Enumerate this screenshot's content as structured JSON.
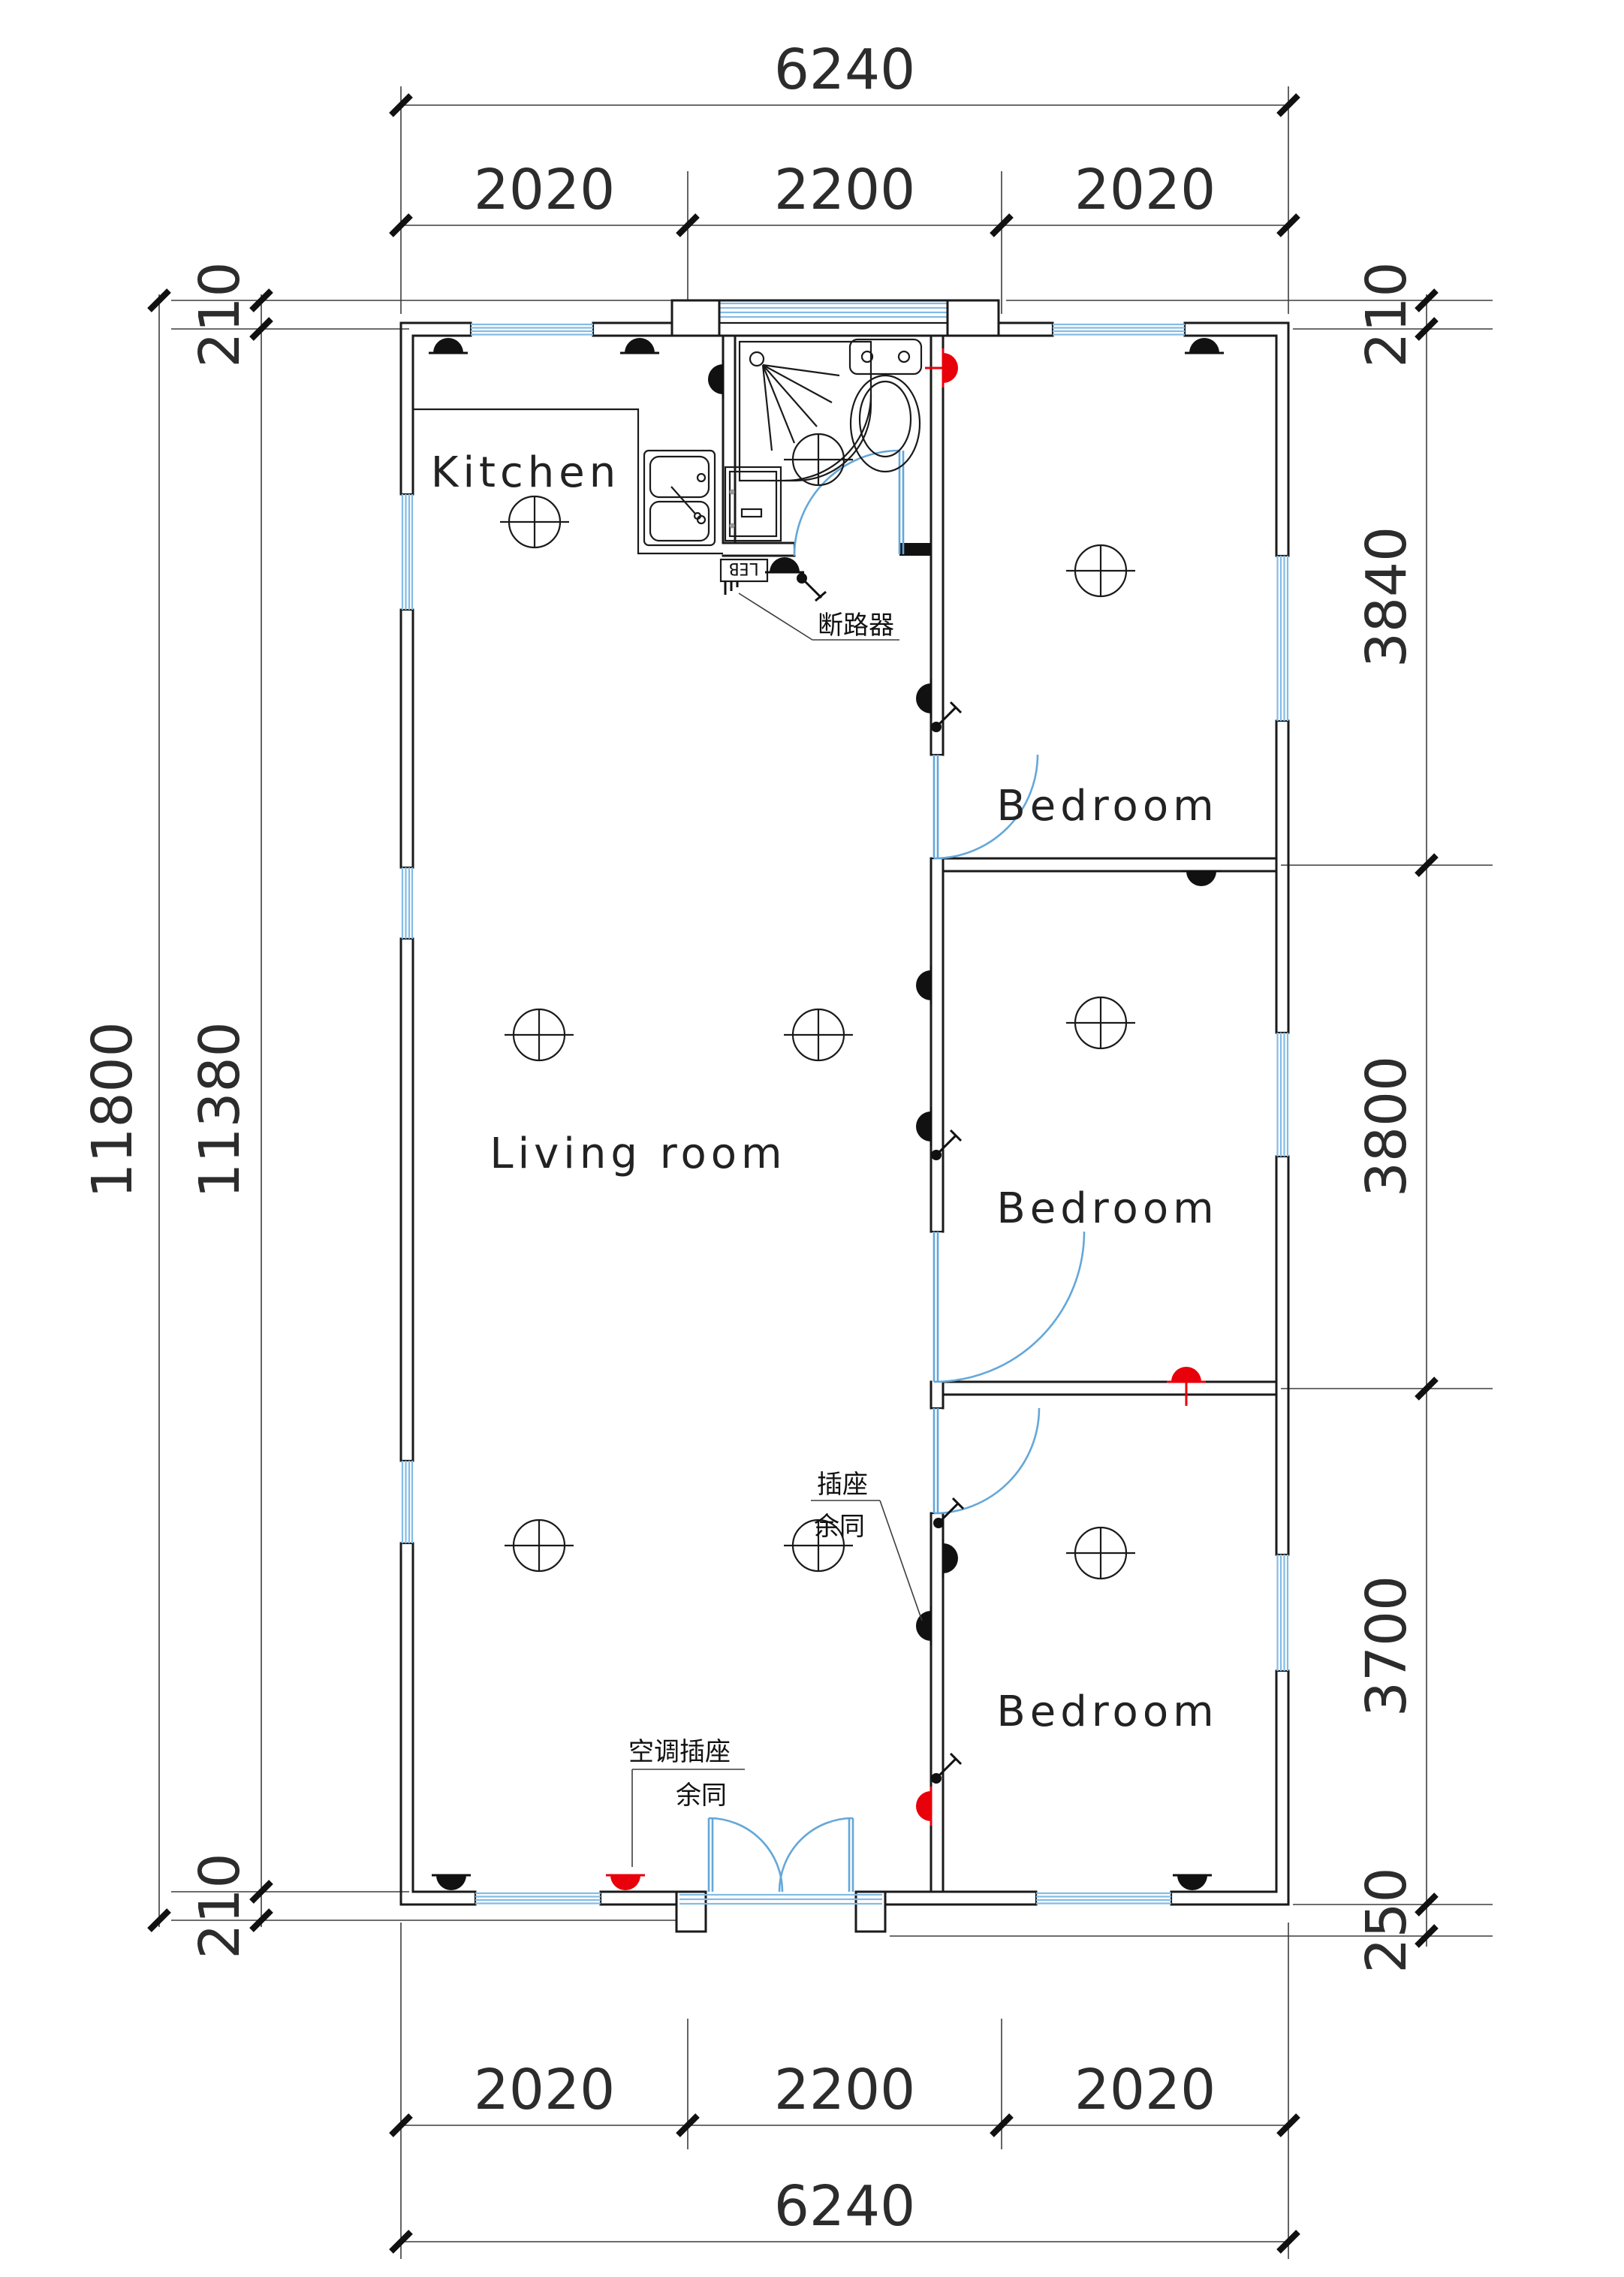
{
  "dims": {
    "top_overall": "6240",
    "top_seg1": "2020",
    "top_seg2": "2200",
    "top_seg3": "2020",
    "bottom_seg1": "2020",
    "bottom_seg2": "2200",
    "bottom_seg3": "2020",
    "bottom_overall": "6240",
    "left_wall_top": "210",
    "left_overall": "11800",
    "left_inner": "11380",
    "left_wall_bottom": "210",
    "right_wall_top": "210",
    "right_seg1": "3840",
    "right_seg2": "3800",
    "right_seg3": "3700",
    "right_wall_bottom": "250"
  },
  "rooms": {
    "kitchen": "Kitchen",
    "living": "Living room",
    "bedroom_top": "Bedroom",
    "bedroom_middle": "Bedroom",
    "bedroom_bottom": "Bedroom"
  },
  "annotations": {
    "circuit_breaker": "断路器",
    "socket_label": "插座",
    "socket_note": "余同",
    "ac_socket_label": "空调插座",
    "ac_socket_note": "余同",
    "distribution_box": "LEB"
  },
  "colors": {
    "line": "#1a1a1a",
    "window": "#84bce5",
    "door_arc": "#64a7d9",
    "special_socket": "#e8000a",
    "dimension": "#3d3d3d"
  }
}
